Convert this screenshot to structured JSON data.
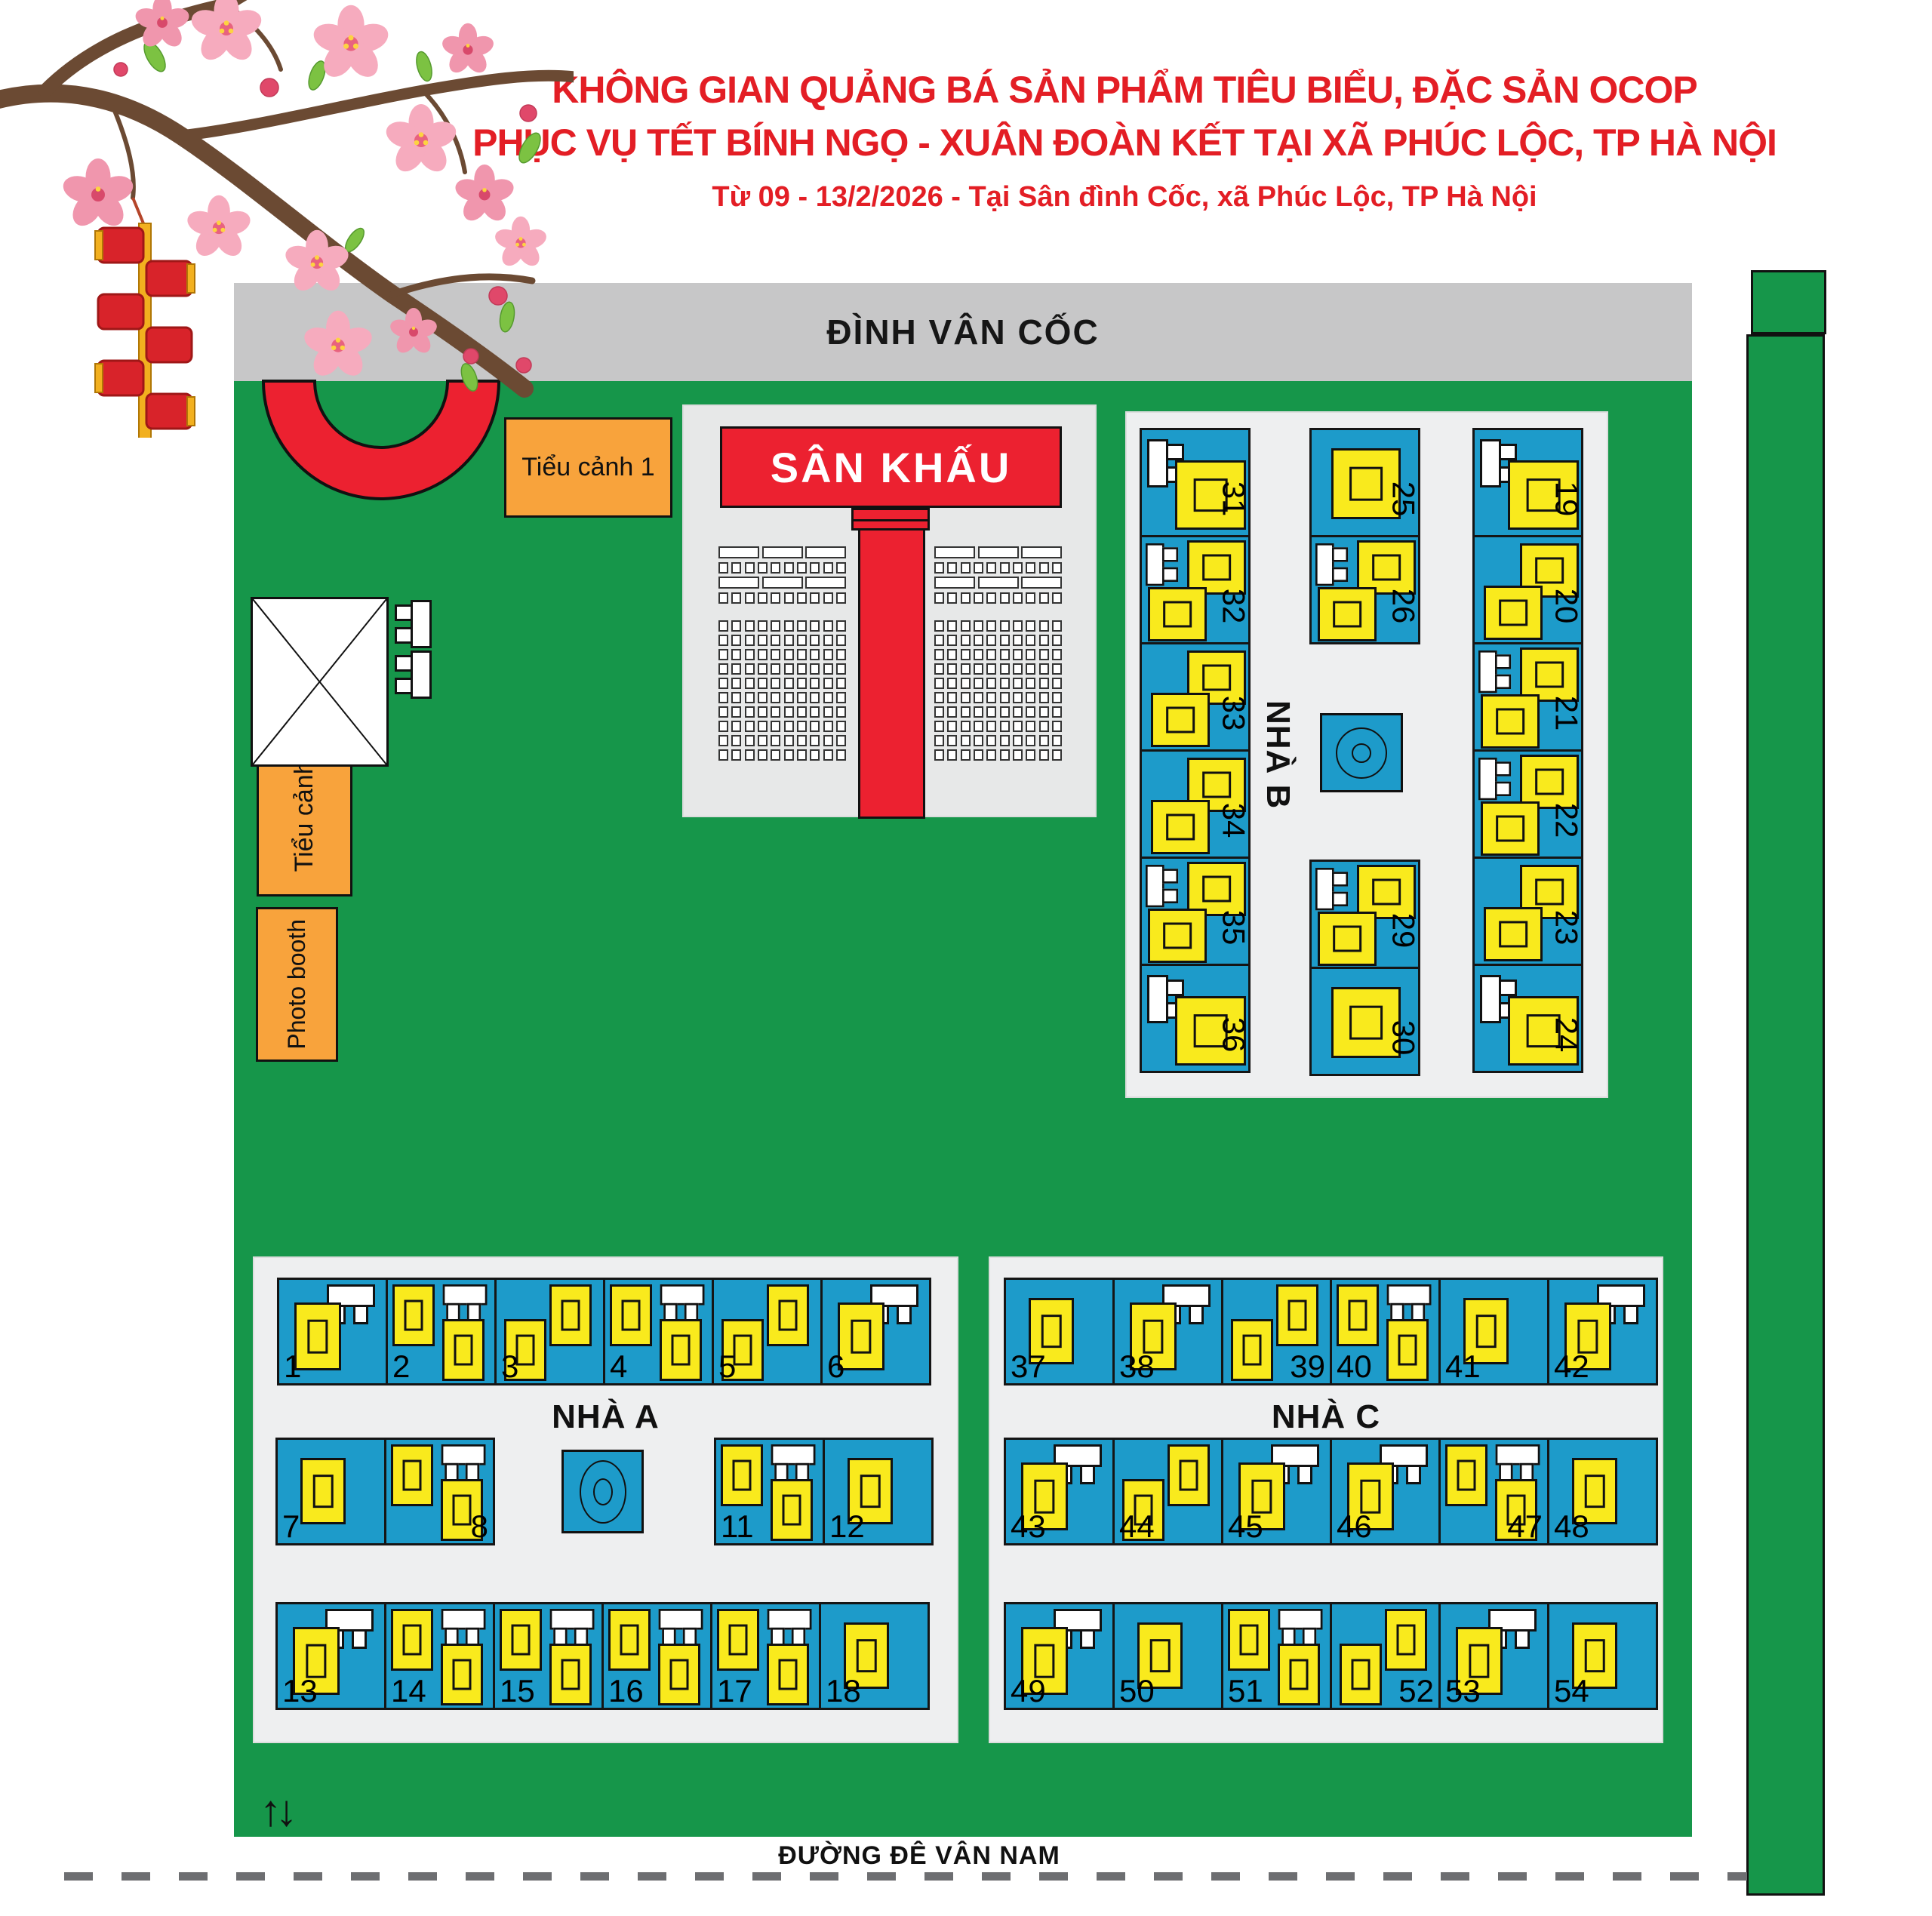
{
  "poster": {
    "title_line1": "KHÔNG GIAN QUẢNG BÁ SẢN PHẨM TIÊU BIỂU, ĐẶC SẢN OCOP",
    "title_line2": "PHỤC VỤ TẾT BÍNH NGỌ - XUÂN ĐOÀN KẾT TẠI XÃ PHÚC LỘC, TP HÀ NỘI",
    "subtitle": "Từ 09 - 13/2/2026 - Tại Sân đình Cốc, xã Phúc Lộc, TP Hà Nội"
  },
  "landmarks": {
    "temple": "ĐÌNH VÂN CỐC",
    "stage": "SÂN KHẤU",
    "scene1": "Tiểu cảnh 1",
    "scene2": "Tiểu cảnh 2",
    "photobooth": "Photo booth",
    "road": "ĐƯỜNG ĐÊ VÂN NAM",
    "entrance_arrows": "↑↓"
  },
  "houses": {
    "a": {
      "label": "NHÀ A",
      "row1": [
        {
          "n": "1",
          "v": 1
        },
        {
          "n": "2",
          "v": 2
        },
        {
          "n": "3",
          "v": 3
        },
        {
          "n": "4",
          "v": 2
        },
        {
          "n": "5",
          "v": 3
        },
        {
          "n": "6",
          "v": 1
        }
      ],
      "row2_left": [
        {
          "n": "7",
          "v": 0
        },
        {
          "n": "8",
          "v": 2,
          "nr": true
        }
      ],
      "row2_right": [
        {
          "n": "11",
          "v": 2
        },
        {
          "n": "12",
          "v": 0
        }
      ],
      "row3": [
        {
          "n": "13",
          "v": 1
        },
        {
          "n": "14",
          "v": 2
        },
        {
          "n": "15",
          "v": 2
        },
        {
          "n": "16",
          "v": 2
        },
        {
          "n": "17",
          "v": 2
        },
        {
          "n": "18",
          "v": 0
        }
      ]
    },
    "b": {
      "label": "NHÀ B",
      "col_left": [
        {
          "n": "31",
          "v": 1
        },
        {
          "n": "32",
          "v": 2
        },
        {
          "n": "33",
          "v": 3
        },
        {
          "n": "34",
          "v": 3
        },
        {
          "n": "35",
          "v": 2
        },
        {
          "n": "36",
          "v": 1
        }
      ],
      "col_mid_top": [
        {
          "n": "25",
          "v": 0
        },
        {
          "n": "26",
          "v": 2
        }
      ],
      "col_mid_bottom": [
        {
          "n": "29",
          "v": 2
        },
        {
          "n": "30",
          "v": 0
        }
      ],
      "col_right": [
        {
          "n": "19",
          "v": 1
        },
        {
          "n": "20",
          "v": 3
        },
        {
          "n": "21",
          "v": 2
        },
        {
          "n": "22",
          "v": 2
        },
        {
          "n": "23",
          "v": 3
        },
        {
          "n": "24",
          "v": 1
        }
      ]
    },
    "c": {
      "label": "NHÀ C",
      "row1": [
        {
          "n": "37",
          "v": 0
        },
        {
          "n": "38",
          "v": 1
        },
        {
          "n": "39",
          "v": 3,
          "nr": true
        },
        {
          "n": "40",
          "v": 2
        },
        {
          "n": "41",
          "v": 0
        },
        {
          "n": "42",
          "v": 1
        }
      ],
      "row2": [
        {
          "n": "43",
          "v": 1
        },
        {
          "n": "44",
          "v": 3
        },
        {
          "n": "45",
          "v": 1
        },
        {
          "n": "46",
          "v": 1
        },
        {
          "n": "47",
          "v": 2,
          "nr": true
        },
        {
          "n": "48",
          "v": 0
        }
      ],
      "row3": [
        {
          "n": "49",
          "v": 1
        },
        {
          "n": "50",
          "v": 0
        },
        {
          "n": "51",
          "v": 2
        },
        {
          "n": "52",
          "v": 3,
          "nr": true
        },
        {
          "n": "53",
          "v": 1
        },
        {
          "n": "54",
          "v": 0
        }
      ]
    }
  },
  "colors": {
    "title_red": "#e31e25",
    "shape_red": "#ec2130",
    "field_green": "#16964a",
    "booth_blue": "#1d9bca",
    "booth_yellow": "#f9ea1d",
    "prop_orange": "#f8a33c",
    "bar_gray": "#c7c7c8",
    "panel_gray": "#eeeff0",
    "dash_gray": "#6d6e71"
  }
}
